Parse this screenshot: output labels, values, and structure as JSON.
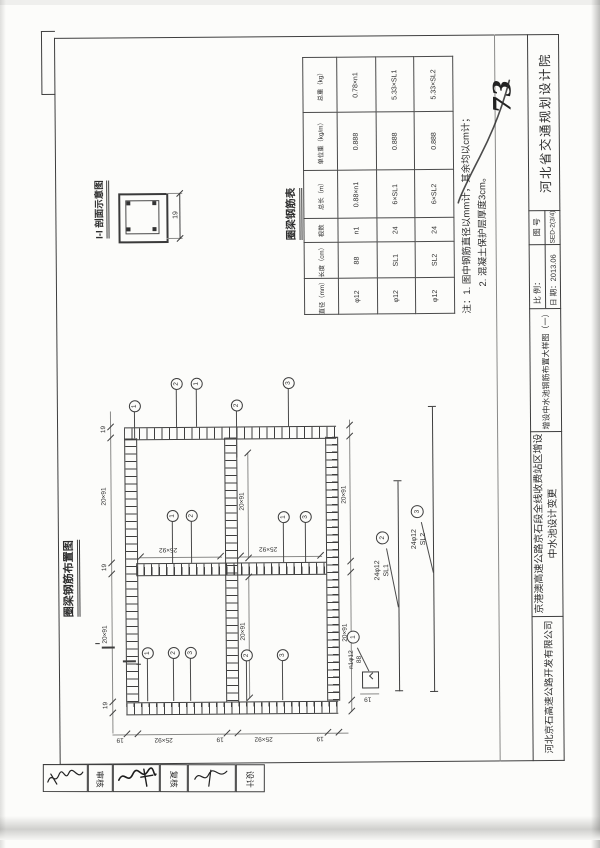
{
  "page": {
    "section_detail": {
      "title": "I-I 剖面示意图",
      "dim": "19"
    },
    "rebar_table": {
      "title": "圈梁钢筋表",
      "headers": [
        "直径（mm）",
        "长度（cm）",
        "根数",
        "总长（m）",
        "单位重（kg/m）",
        "总重（kg）"
      ],
      "rows": [
        [
          "φ12",
          "88",
          "n1",
          "0.88×n1",
          "0.888",
          "0.78×n1"
        ],
        [
          "φ12",
          "SL1",
          "24",
          "6×SL1",
          "0.888",
          "5.33×SL1"
        ],
        [
          "φ12",
          "SL2",
          "24",
          "6×SL2",
          "0.888",
          "5.33×SL2"
        ]
      ]
    },
    "notes": {
      "label": "注：",
      "item1": "1. 图中钢筋直径以mm计，其余均以cm计；",
      "item2": "2. 混凝土保护层厚度3cm。"
    },
    "handwritten_mark": "73",
    "plan": {
      "title": "圈梁钢筋布置图",
      "dim_cell_w": "25×92",
      "dim_cell_h": "20×91",
      "dim_wall": "19",
      "section_mark": "I",
      "callouts": [
        "2",
        "1",
        "3",
        "1",
        "2",
        "1",
        "2",
        "1",
        "3",
        "1",
        "2",
        "3",
        "2",
        "3"
      ]
    },
    "bar_details": {
      "d1": {
        "no": "1",
        "qty": "n1φ12",
        "len": "88",
        "dim": "19"
      },
      "d2": {
        "no": "2",
        "qty": "24φ12",
        "len": "SL1"
      },
      "d3": {
        "no": "3",
        "qty": "24φ12",
        "len": "SL2"
      }
    },
    "title_block": {
      "institute": "河北省交通规划设计院",
      "drawing_no_label": "图 号",
      "drawing_no": "SED-2(3/4)",
      "scale_label": "比 例：",
      "date_label": "日 期：",
      "date": "2013.06",
      "sheet_title": "增设中水池钢筋布置大样图（一）",
      "project": "京港澳高速公路京石段全线收费站区增设中水池设计变更",
      "company": "河北京石高速公路开发有限公司"
    },
    "signatures": {
      "labels": [
        "审核",
        "复核",
        "设计"
      ]
    }
  }
}
